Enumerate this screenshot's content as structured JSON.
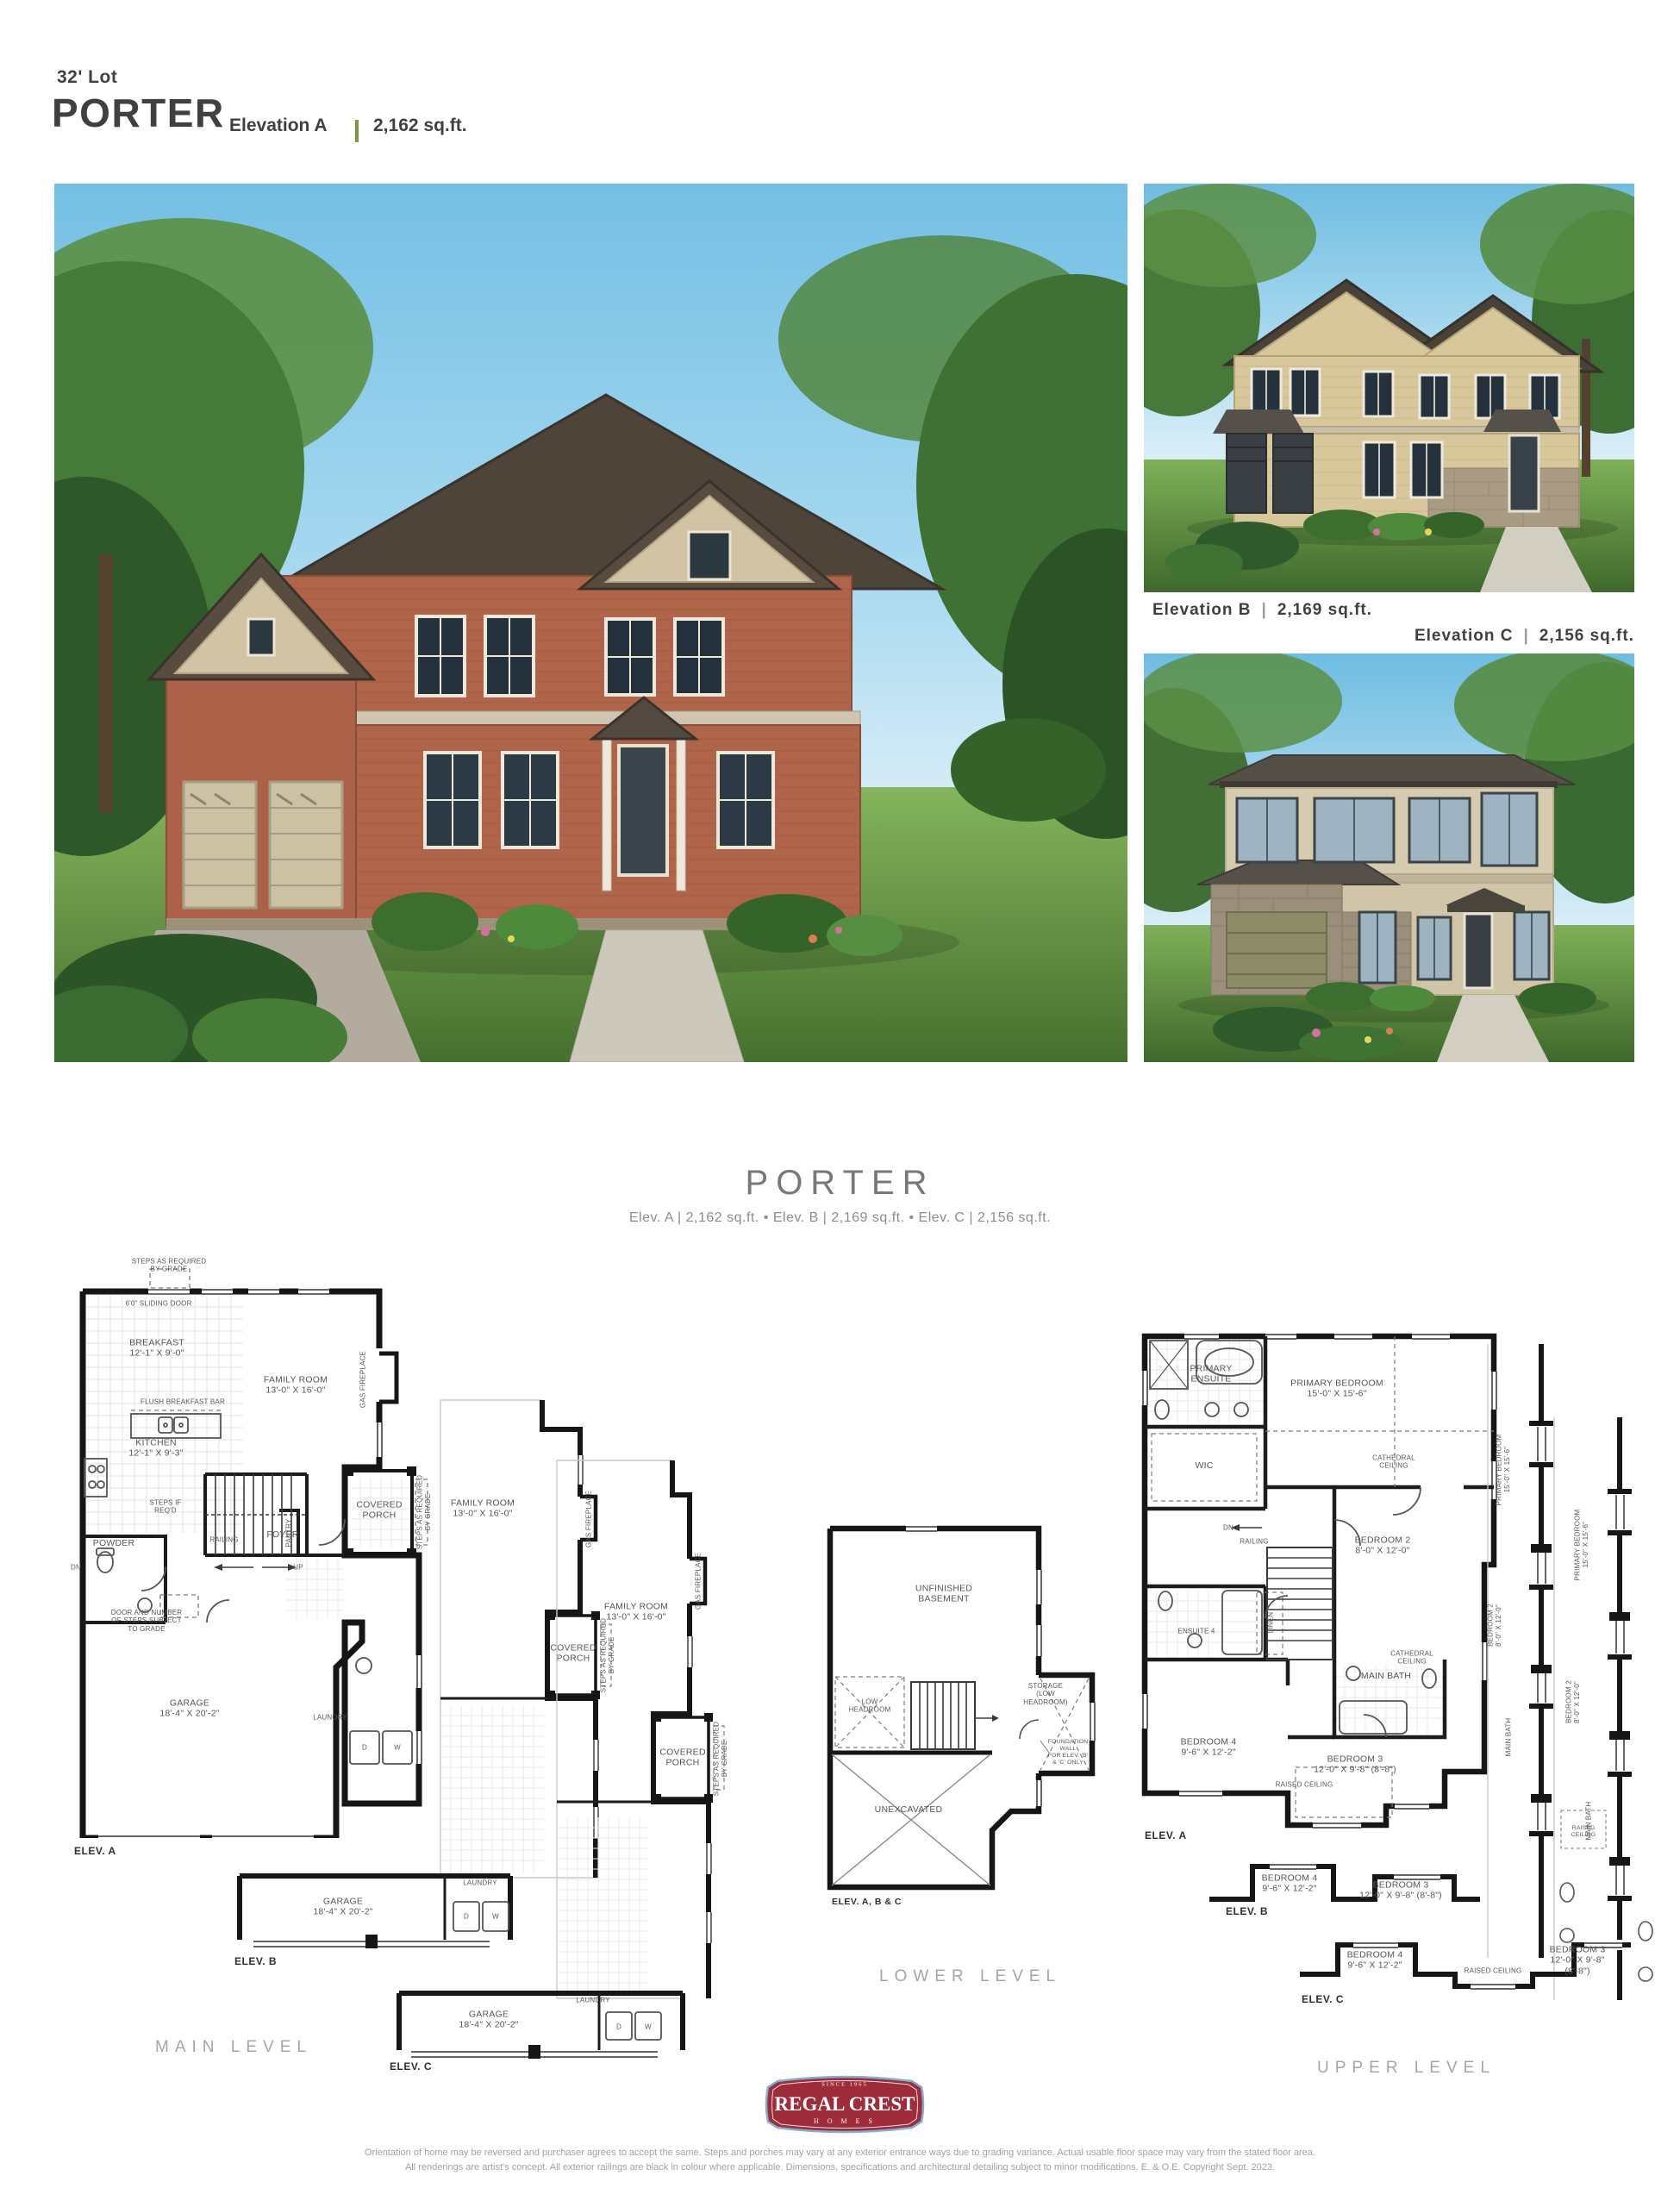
{
  "header": {
    "lot": "32' Lot",
    "name": "PORTER",
    "elevation": "Elevation A",
    "sqft": "2,162 sq.ft."
  },
  "captions": {
    "b_name": "Elevation B",
    "b_sqft": "2,169 sq.ft.",
    "c_name": "Elevation C",
    "c_sqft": "2,156 sq.ft.",
    "pipe": "|"
  },
  "midtitle": {
    "name": "PORTER",
    "specs": "Elev. A  |  2,162 sq.ft.  •  Elev. B  |  2,169  sq.ft.  •  Elev. C  |  2,156  sq.ft."
  },
  "plans": {
    "captions": {
      "main": "MAIN LEVEL",
      "lower": "LOWER LEVEL",
      "upper": "UPPER LEVEL"
    },
    "tags": {
      "a": "ELEV. A",
      "b": "ELEV. B",
      "c": "ELEV. C",
      "abc": "ELEV. A, B & C"
    },
    "main": {
      "steps_grade": "STEPS AS REQUIRED\nBY GRADE",
      "sliding_door": "6'0\" SLIDING DOOR",
      "breakfast": "BREAKFAST\n12'-1\" X 9'-0\"",
      "family": "FAMILY ROOM\n13'-0\" X 16'-0\"",
      "flush_bar": "FLUSH BREAKFAST BAR",
      "kitchen": "KITCHEN\n12'-1\" X 9'-3\"",
      "gas_fireplace": "GAS FIREPLACE",
      "pantry": "PANTRY",
      "steps_if": "STEPS IF\nREQ'D",
      "railing": "RAILING",
      "dn": "DN",
      "up": "UP",
      "powder": "POWDER",
      "foyer": "FOYER",
      "door_note": "DOOR AND NUMBER\nOF STEPS SUBJECT\nTO GRADE",
      "garage": "GARAGE\n18'-4\" X 20'-2\"",
      "covered_porch": "COVERED\nPORCH",
      "steps_grade_side": "STEPS AS REQUIRED\nBY GRADE",
      "laundry": "LAUNDRY",
      "d": "D",
      "w": "W"
    },
    "lower": {
      "unfinished": "UNFINISHED\nBASEMENT",
      "low_headroom": "LOW\nHEADROOM",
      "storage": "STORAGE\n(LOW\nHEADROOM)",
      "unexcavated": "UNEXCAVATED",
      "foundation": "FOUNDATION WALL\nFOR ELEV. 'B' & 'C' ONLY"
    },
    "upper": {
      "primary_ensuite": "PRIMARY\nENSUITE",
      "primary_bedroom": "PRIMARY BEDROOM\n15'-0\" X 15'-6\"",
      "wic": "WIC",
      "cathedral": "CATHEDRAL\nCEILING",
      "dn": "DN",
      "railing": "RAILING",
      "bedroom2": "BEDROOM 2\n8'-0\" X 12'-0\"",
      "ensuite4": "ENSUITE 4",
      "linen": "LINEN",
      "main_bath": "MAIN BATH",
      "bedroom4": "BEDROOM 4\n9'-6\" X 12'-2\"",
      "bedroom3": "BEDROOM 3\n12'-0\" X 9'-8\" (8'-8\")",
      "raised": "RAISED CEILING"
    }
  },
  "footer": {
    "logo": {
      "since": "SINCE 1965",
      "name": "REGAL CREST",
      "homes": "H O M E S"
    },
    "disclaimer1": "Orientation of home may be reversed and purchaser agrees to accept the same. Steps and porches may vary at any exterior entrance ways due to grading variance. Actual usable floor space may vary from the stated floor area.",
    "disclaimer2": "All renderings are artist's concept. All exterior railings are black in colour where applicable. Dimensions, specifications and architectural detailing subject to minor modifications. E. & O.E. Copyright Sept. 2023."
  },
  "colors": {
    "accent_green": "#7a9a3f",
    "brand_red": "#9e2c3b",
    "brand_blue": "#7fb0d4",
    "title_gray": "#77787a",
    "text_dark": "#3f4042"
  }
}
